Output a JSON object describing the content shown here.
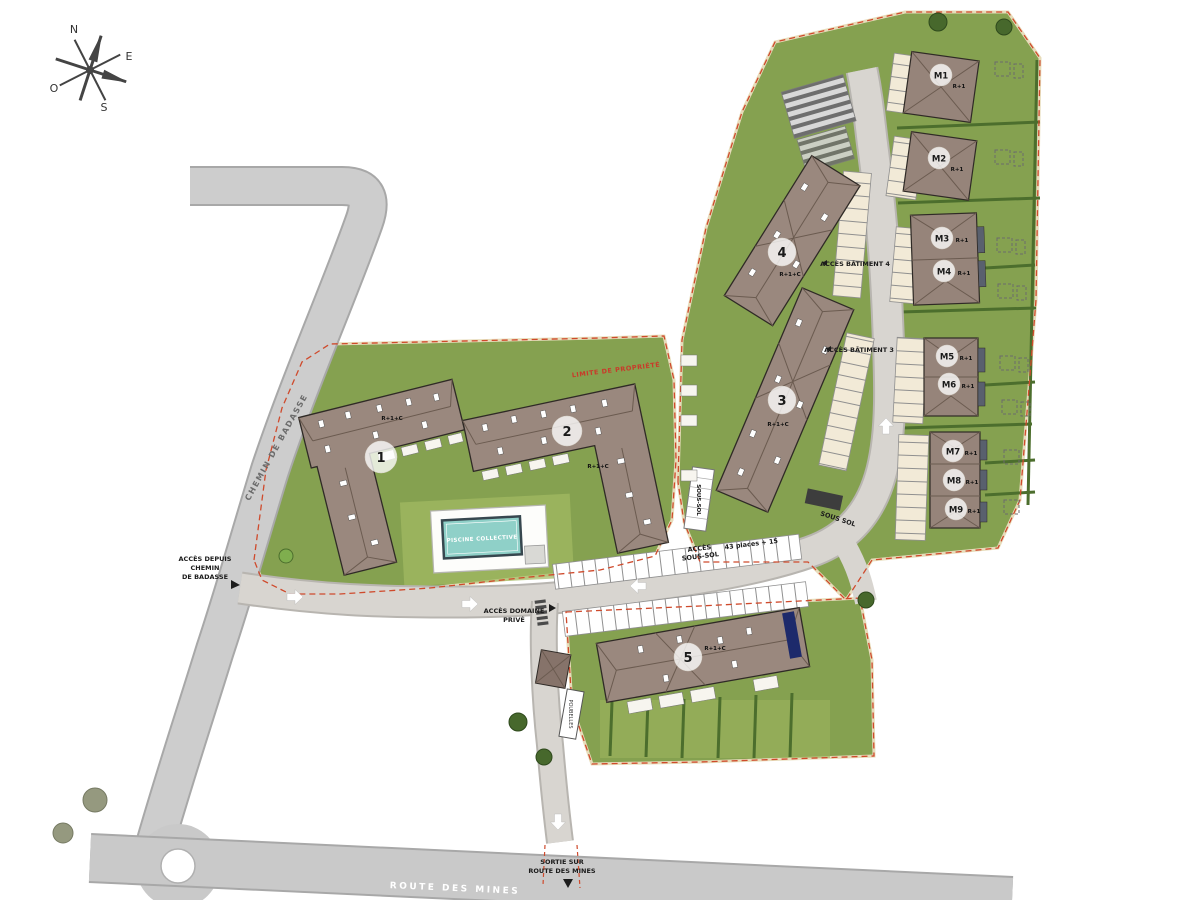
{
  "compass": {
    "n": "N",
    "e": "E",
    "s": "S",
    "o": "O"
  },
  "roads": {
    "chemin_de_badasse": "CHEMIN DE BADASSE",
    "route_des_mines": "ROUTE DES MINES"
  },
  "labels": {
    "limite": "LIMITE DE PROPRIÉTÉ",
    "acces_badasse_1": "ACCÈS DEPUIS",
    "acces_badasse_2": "CHEMIN",
    "acces_badasse_3": "DE BADASSE",
    "acces_domaine_1": "ACCÈS DOMAINE",
    "acces_domaine_2": "PRIVÉ",
    "acces_bat4": "ACCÈS BÂTIMENT 4",
    "acces_bat3": "ACCÈS BÂTIMENT 3",
    "acces_soussol_1": "ACCÈS",
    "acces_soussol_2": "SOUS-SOL",
    "places": "43 places + 15",
    "soussol_curve": "SOUS SOL",
    "ramp": "SOUS-SOL",
    "sortie_1": "SORTIE SUR",
    "sortie_2": "ROUTE DES MINES",
    "poubelles": "POUBELLES"
  },
  "pool": {
    "label": "PISCINE COLLECTIVE"
  },
  "buildings": {
    "b1": {
      "num": "1",
      "storeys": "R+1+C"
    },
    "b2": {
      "num": "2",
      "storeys": "R+1+C"
    },
    "b3": {
      "num": "3",
      "storeys": "R+1+C"
    },
    "b4": {
      "num": "4",
      "storeys": "R+1+C"
    },
    "b5": {
      "num": "5",
      "storeys": "R+1+C"
    },
    "m1": {
      "num": "M1",
      "storeys": "R+1"
    },
    "m2": {
      "num": "M2",
      "storeys": "R+1"
    },
    "m3": {
      "num": "M3",
      "storeys": "R+1"
    },
    "m4": {
      "num": "M4",
      "storeys": "R+1"
    },
    "m5": {
      "num": "M5",
      "storeys": "R+1"
    },
    "m6": {
      "num": "M6",
      "storeys": "R+1"
    },
    "m7": {
      "num": "M7",
      "storeys": "R+1"
    },
    "m8": {
      "num": "M8",
      "storeys": "R+1"
    },
    "m9": {
      "num": "M9",
      "storeys": "R+1"
    }
  },
  "colors": {
    "lawn_green": "#85a150",
    "hedge_green": "#4c6e2d",
    "roof_brown": "#9a887e",
    "road_gray": "#c9c9c9",
    "pool_teal": "#8fd0c8",
    "boundary_red": "#cf4a2c",
    "parking_beige": "#f2ead7"
  }
}
